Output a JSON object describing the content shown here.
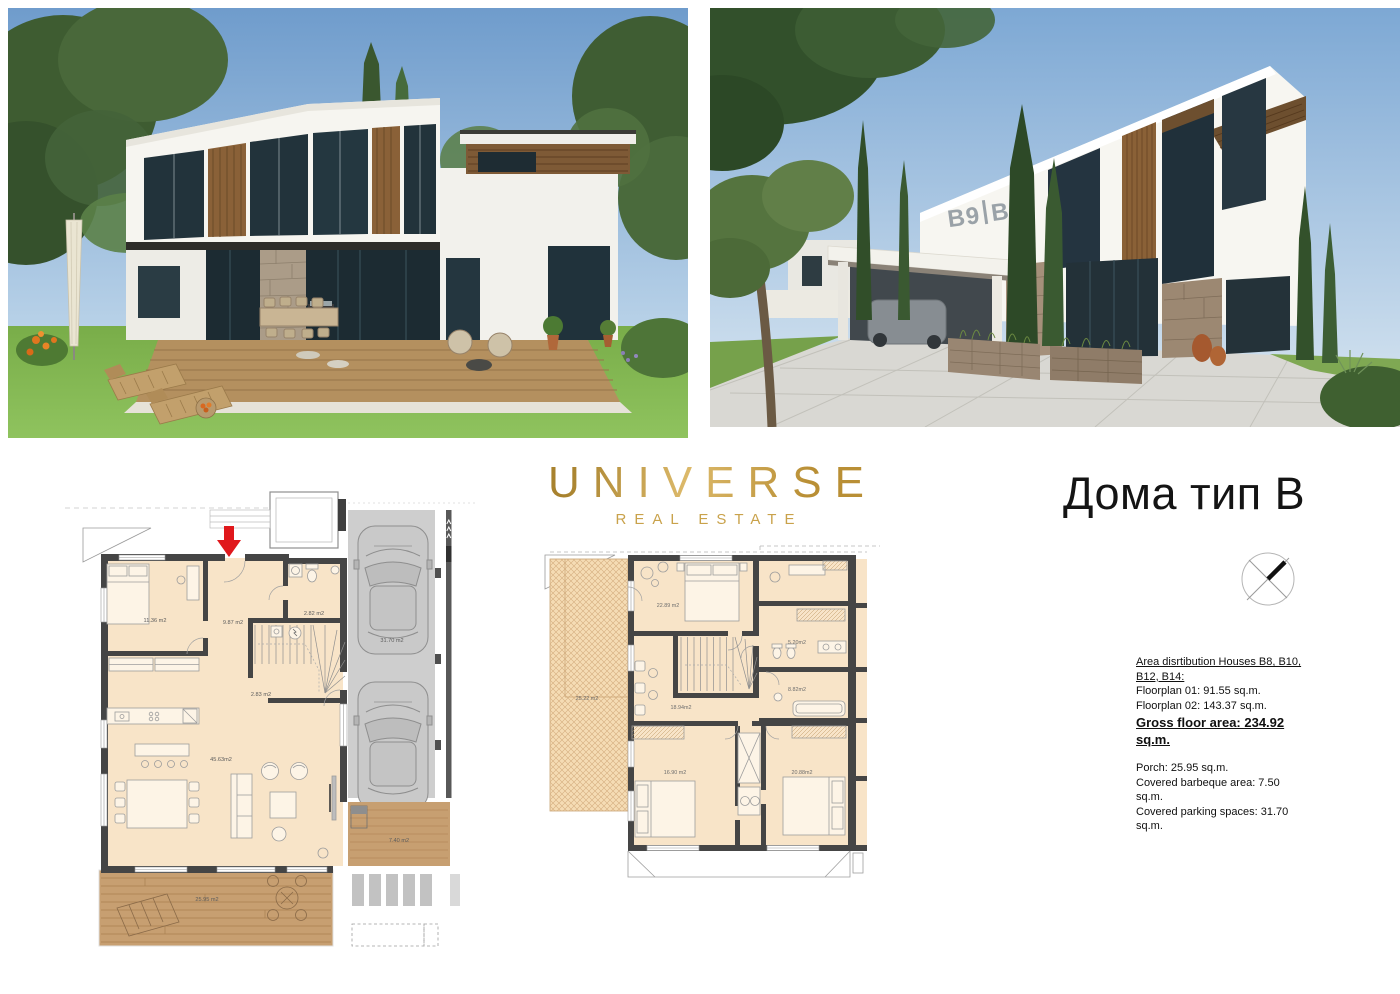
{
  "logo": {
    "title": "UNIVERSE",
    "subtitle": "REAL ESTATE",
    "gold": "#c49a3f"
  },
  "heading": {
    "title": "Дома тип B"
  },
  "photos": {
    "left": {
      "name": "garden view render of house type B"
    },
    "right": {
      "name": "street view render of houses",
      "facade_sign_left": "B9",
      "facade_sign_right": "B8"
    }
  },
  "floorplan1": {
    "name": "Floorplan 01 — ground floor",
    "rooms": {
      "bedroom": "11.36 m2",
      "hall": "9.87 m2",
      "wc": "2.82 m2",
      "stairs": "2.83 m2",
      "living": "45.63m2",
      "deck": "25.95 m2",
      "side_deck": "7.40 m2",
      "parking": "31.70 m2"
    }
  },
  "floorplan2": {
    "name": "Floorplan 02 — upper floor",
    "rooms": {
      "terrace": "25.22 m2",
      "bedroom1": "22.89 m2",
      "bath1": "5.20m2",
      "lounge": "18.94m2",
      "bath2": "8.82m2",
      "bedroom2": "16.90 m2",
      "bedroom3": "20.88m2"
    }
  },
  "info": {
    "heading": "Area disrtibution Houses B8, B10, B12, B14:",
    "floorplan01": "Floorplan 01: 91.55 sq.m.",
    "floorplan02": "Floorplan 02: 143.37 sq.m.",
    "gross": "Gross floor area: 234.92 sq.m.",
    "porch": "Porch: 25.95 sq.m.",
    "barbeque": "Covered barbeque area: 7.50 sq.m.",
    "parking": "Covered parking spaces: 31.70 sq.m."
  }
}
